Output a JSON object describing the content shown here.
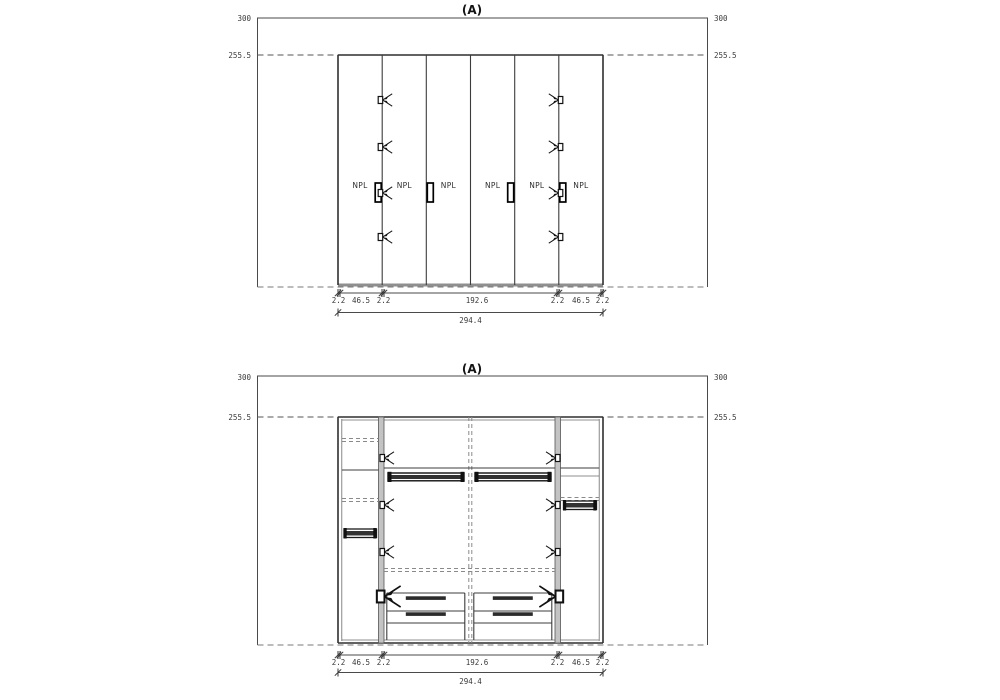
{
  "colors": {
    "background": "#ffffff",
    "line": "#3c3c3c",
    "dashed": "#7a7a7a",
    "panel_gray": "#c3c3c3",
    "dark": "#111111",
    "text": "#3a3a3a"
  },
  "icons": {
    "hinge": "hinge-fork-icon",
    "handle": "door-handle",
    "rail": "hanging-rail",
    "tick": "dimension-tick"
  },
  "heights": {
    "ceiling": "300",
    "unit": "255.5"
  },
  "dims": {
    "detail": [
      "2.2",
      "46.5",
      "2.2",
      "192.6",
      "2.2",
      "46.5",
      "2.2"
    ],
    "total": "294.4"
  },
  "top_view": {
    "title": "(A)",
    "door_labels": [
      "NPL",
      "NPL",
      "NPL",
      "NPL",
      "NPL",
      "NPL"
    ]
  },
  "bottom_view": {
    "title": "(A)"
  }
}
